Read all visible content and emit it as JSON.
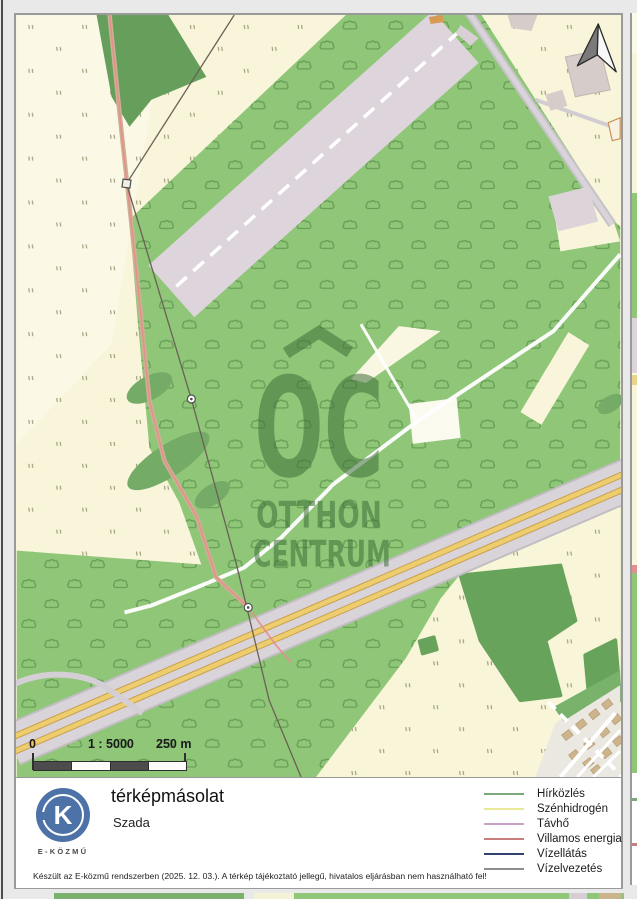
{
  "map": {
    "watermark": {
      "initials": "OC",
      "line1": "OTTHON",
      "line2": "CENTRUM"
    },
    "scale_bar": {
      "zero_label": "0",
      "ratio_label": "1 : 5000",
      "distance_label": "250 m"
    },
    "symbols": {
      "north_arrow_icon": "north-arrow",
      "scrub_icon": "bush-outline",
      "grass_icon": "grass-ticks"
    }
  },
  "footer": {
    "logo": {
      "letter": "K",
      "caption": "E-KÖZMŰ"
    },
    "title": "térképmásolat",
    "subtitle": "Szada",
    "disclaimer": "Készült az E-közmű rendszerben (2025. 12. 03.). A térkép tájékoztató jellegű, hivatalos eljárásban nem használható fel!"
  },
  "legend": {
    "items": [
      {
        "label": "Hírközlés",
        "color": "#7da87a"
      },
      {
        "label": "Szénhidrogén",
        "color": "#eae89a"
      },
      {
        "label": "Távhő",
        "color": "#c7a3cb"
      },
      {
        "label": "Villamos energia",
        "color": "#c97d7d"
      },
      {
        "label": "Vízellátás",
        "color": "#33426e"
      },
      {
        "label": "Vízelvezetés",
        "color": "#8e8e92"
      }
    ]
  },
  "colors": {
    "field_cream": "#f8f5da",
    "green": "#8fc678",
    "dark_green": "#68a35c",
    "lavender_parcel": "#ded5dc",
    "highway_yellow": "#edcd6e",
    "logo_blue": "#4d72a7",
    "watermark_green": "#3f6f3a"
  }
}
